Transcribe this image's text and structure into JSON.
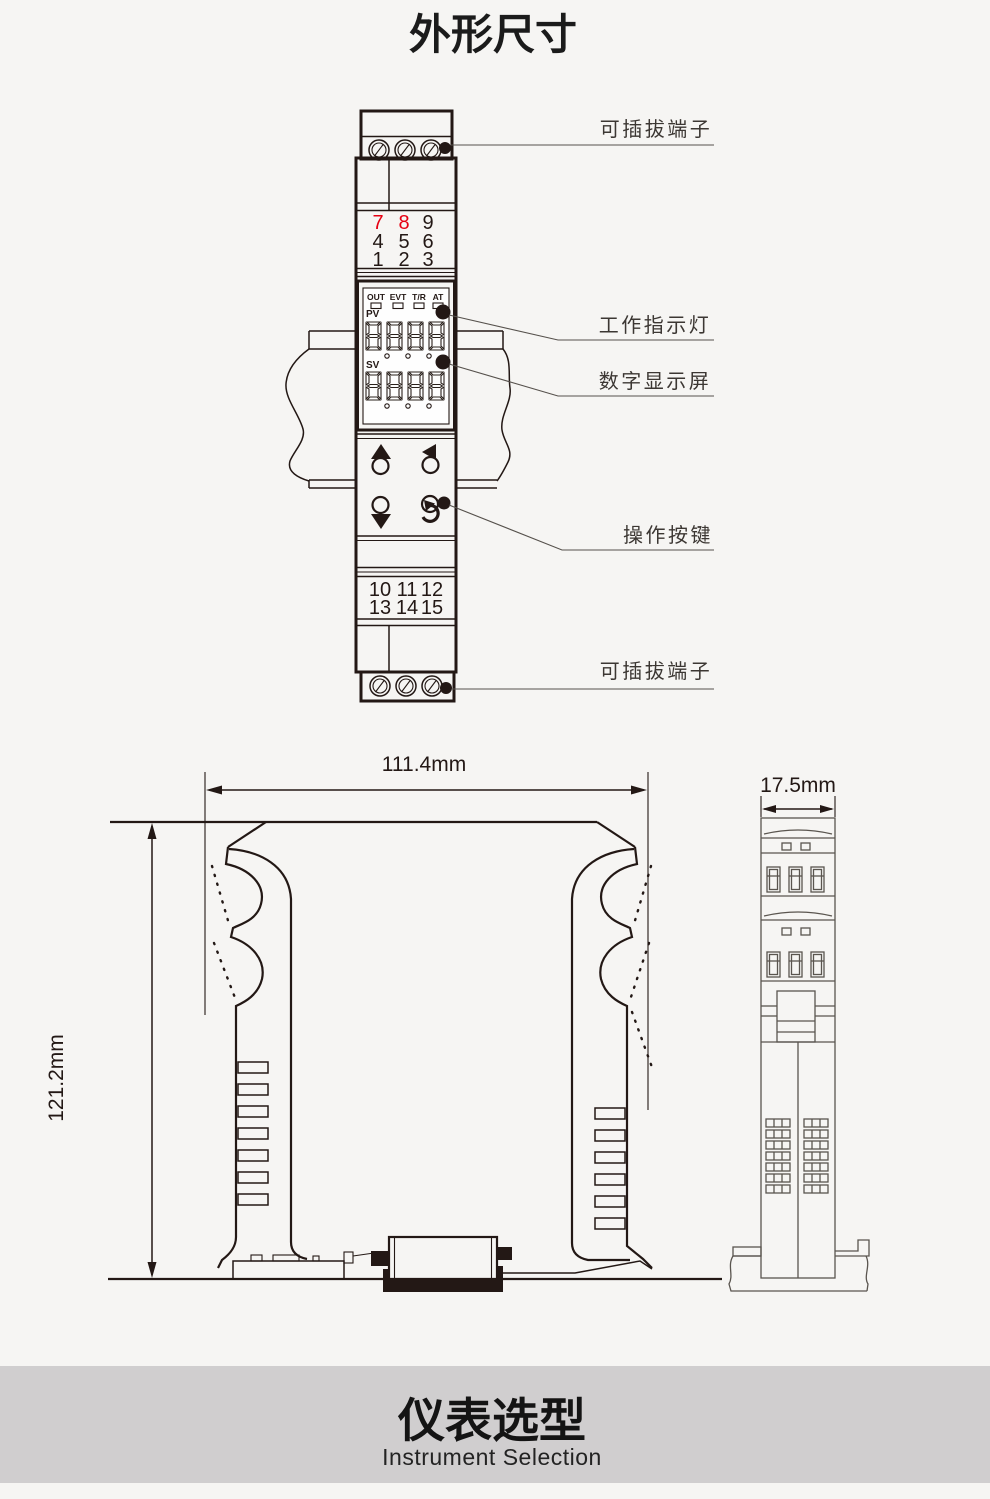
{
  "title": "外形尺寸",
  "colors": {
    "background": "#f6f5f3",
    "line": "#231815",
    "red_terminal": "#e60012",
    "footer_band": "#d0cecf"
  },
  "front_view": {
    "top_terminal_rows": [
      {
        "cells": [
          "7",
          "8",
          "9"
        ]
      },
      {
        "cells": [
          "4",
          "5",
          "6"
        ]
      },
      {
        "cells": [
          "1",
          "2",
          "3"
        ]
      }
    ],
    "bottom_terminal_rows": [
      {
        "cells": [
          "10",
          "11",
          "12"
        ]
      },
      {
        "cells": [
          "13",
          "14",
          "15"
        ]
      }
    ],
    "indicators": [
      "OUT",
      "EVT",
      "T/R",
      "AT"
    ],
    "pv_label": "PV",
    "sv_label": "SV",
    "pv_digits": "8888",
    "sv_digits": "8888",
    "callouts": {
      "top_terminal": "可插拔端子",
      "status_leds": "工作指示灯",
      "display": "数字显示屏",
      "buttons": "操作按键",
      "bottom_terminal": "可插拔端子"
    }
  },
  "dimensions": {
    "width": "111.4mm",
    "height": "121.2mm",
    "depth": "17.5mm"
  },
  "footer": {
    "title": "仪表选型",
    "subtitle": "Instrument Selection"
  }
}
